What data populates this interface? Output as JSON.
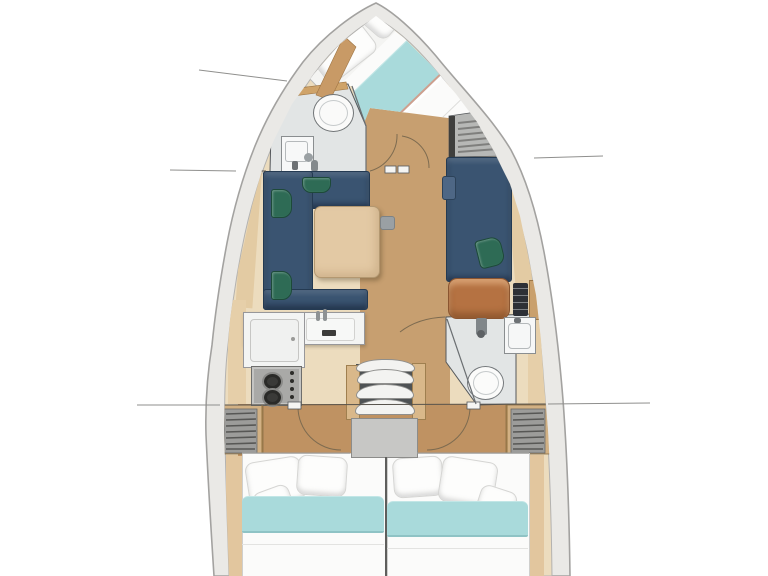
{
  "title": "Sailing yacht interior layout — top-down floor plan",
  "colors": {
    "page_bg": "#ffffff",
    "hull_band": "#eae9e6",
    "hull_edge": "#a3a2a0",
    "interior_base": "#ecdcbe",
    "floor_wood": "#c79f70",
    "floor_wood_aft": "#bf9262",
    "sofa_navy": "#3a5471",
    "cushion_green": "#2e6b55",
    "table_wood": "#e3c9a4",
    "seat_leather": "#b57242",
    "blanket_teal": "#a9dadb",
    "bed_white": "#fbfbfa",
    "bath_floor": "#e2e5e5",
    "counter_white": "#f3f4f3",
    "wardrobe_gray": "#9c9c9a",
    "wood_trim": "#cfa369",
    "stairs_wood": "#d9b88a",
    "landing_gray": "#c7c7c5",
    "stove_steel": "#a9a9a7",
    "instrument_panel_dark": "#2d3036",
    "leader_line": "#8f8f8d"
  },
  "layout": {
    "vessel": "monohull sailboat, bow at top, stern cut off at bottom",
    "rooms": [
      {
        "id": "bow-cabin",
        "label": "Bow cabin with angled double berth, white duvet, teal blanket band, two pillows"
      },
      {
        "id": "forward-bathroom",
        "label": "Forward head with round toilet, sink unit and shower fittings"
      },
      {
        "id": "salon",
        "label": "Salon with U-shaped navy sofa, three green accent cushions, square wood table, opposite straight navy sofa with green cushion"
      },
      {
        "id": "nav-station",
        "label": "Navigator seat in brown leather with dark instrument panel"
      },
      {
        "id": "galley",
        "label": "L-shaped galley with fridge lid, sink, faucets and two-burner stove"
      },
      {
        "id": "aft-bathroom",
        "label": "Aft head with shower, sink and toilet"
      },
      {
        "id": "companionway",
        "label": "Companionway with three curved steps, wood rails and gray landing"
      },
      {
        "id": "aft-cabin-port",
        "label": "Port aft cabin with double berth, three pillows, teal blanket band"
      },
      {
        "id": "aft-cabin-starboard",
        "label": "Starboard aft cabin with double berth, three pillows, teal blanket band"
      }
    ],
    "storage": [
      {
        "id": "wardrobe-bow",
        "label": "Louvered wardrobe beside bow cabin entry"
      },
      {
        "id": "wardrobe-port-aft",
        "label": "Louvered wardrobe port side aft"
      },
      {
        "id": "wardrobe-starboard-aft",
        "label": "Louvered wardrobe starboard side aft"
      }
    ],
    "annotations": {
      "leader_lines": 5,
      "door_swing_arcs": 5,
      "note": "thin gray leader lines extend from bulkheads beyond the hull on both sides; no text labels are present"
    }
  }
}
